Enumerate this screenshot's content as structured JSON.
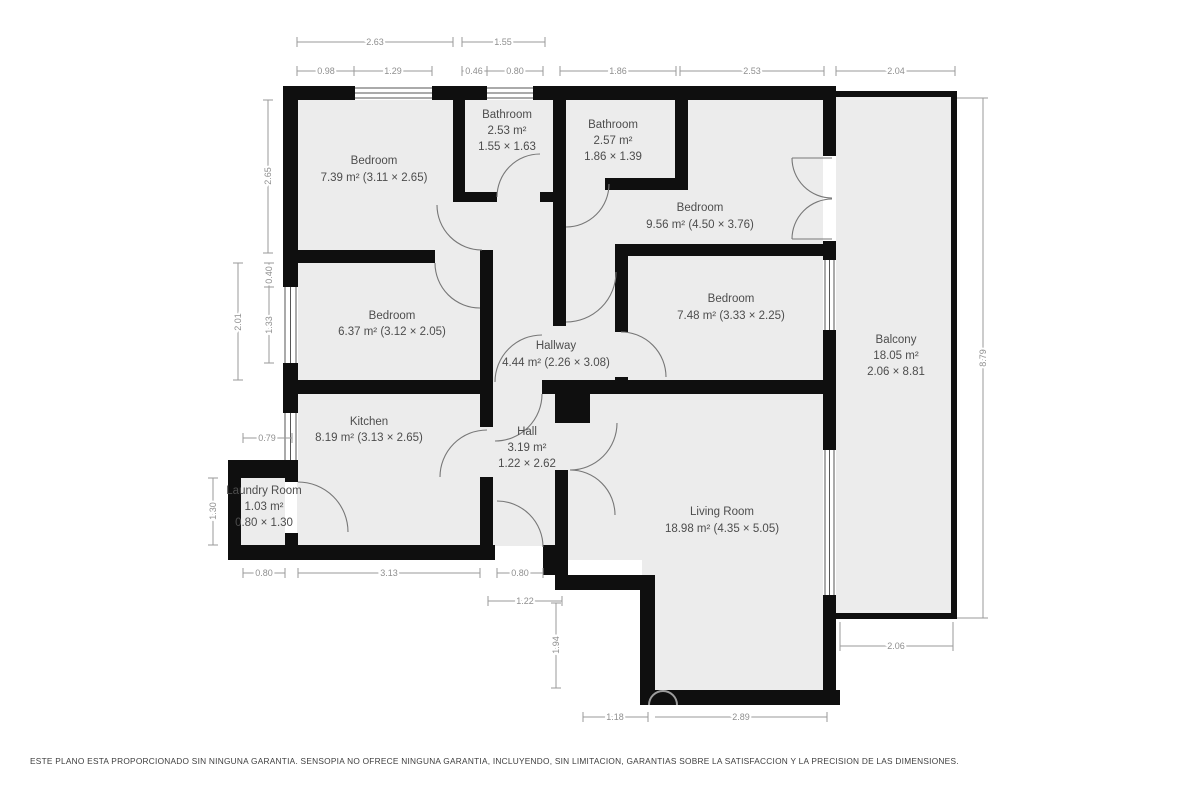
{
  "rooms": [
    {
      "id": "bedroom-top-left",
      "name": "Bedroom",
      "area": "7.39 m² (3.11 × 2.65)"
    },
    {
      "id": "bathroom-1",
      "name": "Bathroom",
      "area": "2.53 m²",
      "size": "1.55 × 1.63"
    },
    {
      "id": "bathroom-2",
      "name": "Bathroom",
      "area": "2.57 m²",
      "size": "1.86 × 1.39"
    },
    {
      "id": "bedroom-top-right",
      "name": "Bedroom",
      "area": "9.56 m² (4.50 × 3.76)"
    },
    {
      "id": "bedroom-mid-right",
      "name": "Bedroom",
      "area": "7.48 m² (3.33 × 2.25)"
    },
    {
      "id": "bedroom-mid-left",
      "name": "Bedroom",
      "area": "6.37 m² (3.12 × 2.05)"
    },
    {
      "id": "hallway",
      "name": "Hallway",
      "area": "4.44 m² (2.26 × 3.08)"
    },
    {
      "id": "kitchen",
      "name": "Kitchen",
      "area": "8.19 m² (3.13 × 2.65)"
    },
    {
      "id": "hall",
      "name": "Hall",
      "area": "3.19 m²",
      "size": "1.22 × 2.62"
    },
    {
      "id": "laundry-room",
      "name": "Laundry Room",
      "area": "1.03 m²",
      "size": "0.80 × 1.30"
    },
    {
      "id": "living-room",
      "name": "Living Room",
      "area": "18.98 m² (4.35 × 5.05)"
    },
    {
      "id": "balcony",
      "name": "Balcony",
      "area": "18.05 m²",
      "size": "2.06 × 8.81"
    }
  ],
  "dimensions": [
    "2.63",
    "1.55",
    "0.98",
    "1.29",
    "0.46",
    "0.80",
    "1.86",
    "2.53",
    "2.04",
    "2.65",
    "0.40",
    "2.01",
    "1.33",
    "0.79",
    "1.30",
    "8.79",
    "0.80",
    "3.13",
    "0.80",
    "1.22",
    "1.94",
    "1.18",
    "2.89",
    "2.06"
  ],
  "footer": "ESTE PLANO ESTA PROPORCIONADO SIN NINGUNA GARANTIA. SENSOPIA NO OFRECE NINGUNA GARANTIA, INCLUYENDO, SIN LIMITACION, GARANTIAS SOBRE LA SATISFACCION Y LA PRECISION DE LAS DIMENSIONES."
}
